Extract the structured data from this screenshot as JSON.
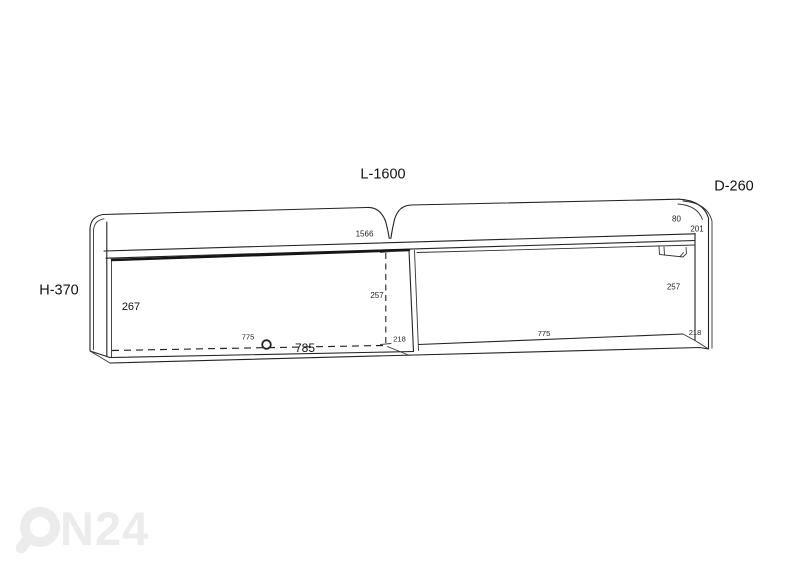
{
  "diagram": {
    "subject": "wall-shelf technical dimension drawing",
    "background": "#ffffff",
    "line_color": "#222222",
    "title_labels": {
      "length": "L-1600",
      "depth": "D-260",
      "height": "H-370"
    },
    "dimension_labels": {
      "inner_length": "1566",
      "back_rail_height": "80",
      "right_top_depth": "201",
      "door_height": "267",
      "door_inner_height": "257",
      "right_inner_height": "257",
      "left_inner_width": "775",
      "door_width": "785",
      "left_inner_depth": "218",
      "right_inner_width": "775",
      "right_inner_depth": "218"
    }
  },
  "watermark": {
    "text": "N24",
    "icon": "magnifier-o",
    "color": "#ececec"
  }
}
